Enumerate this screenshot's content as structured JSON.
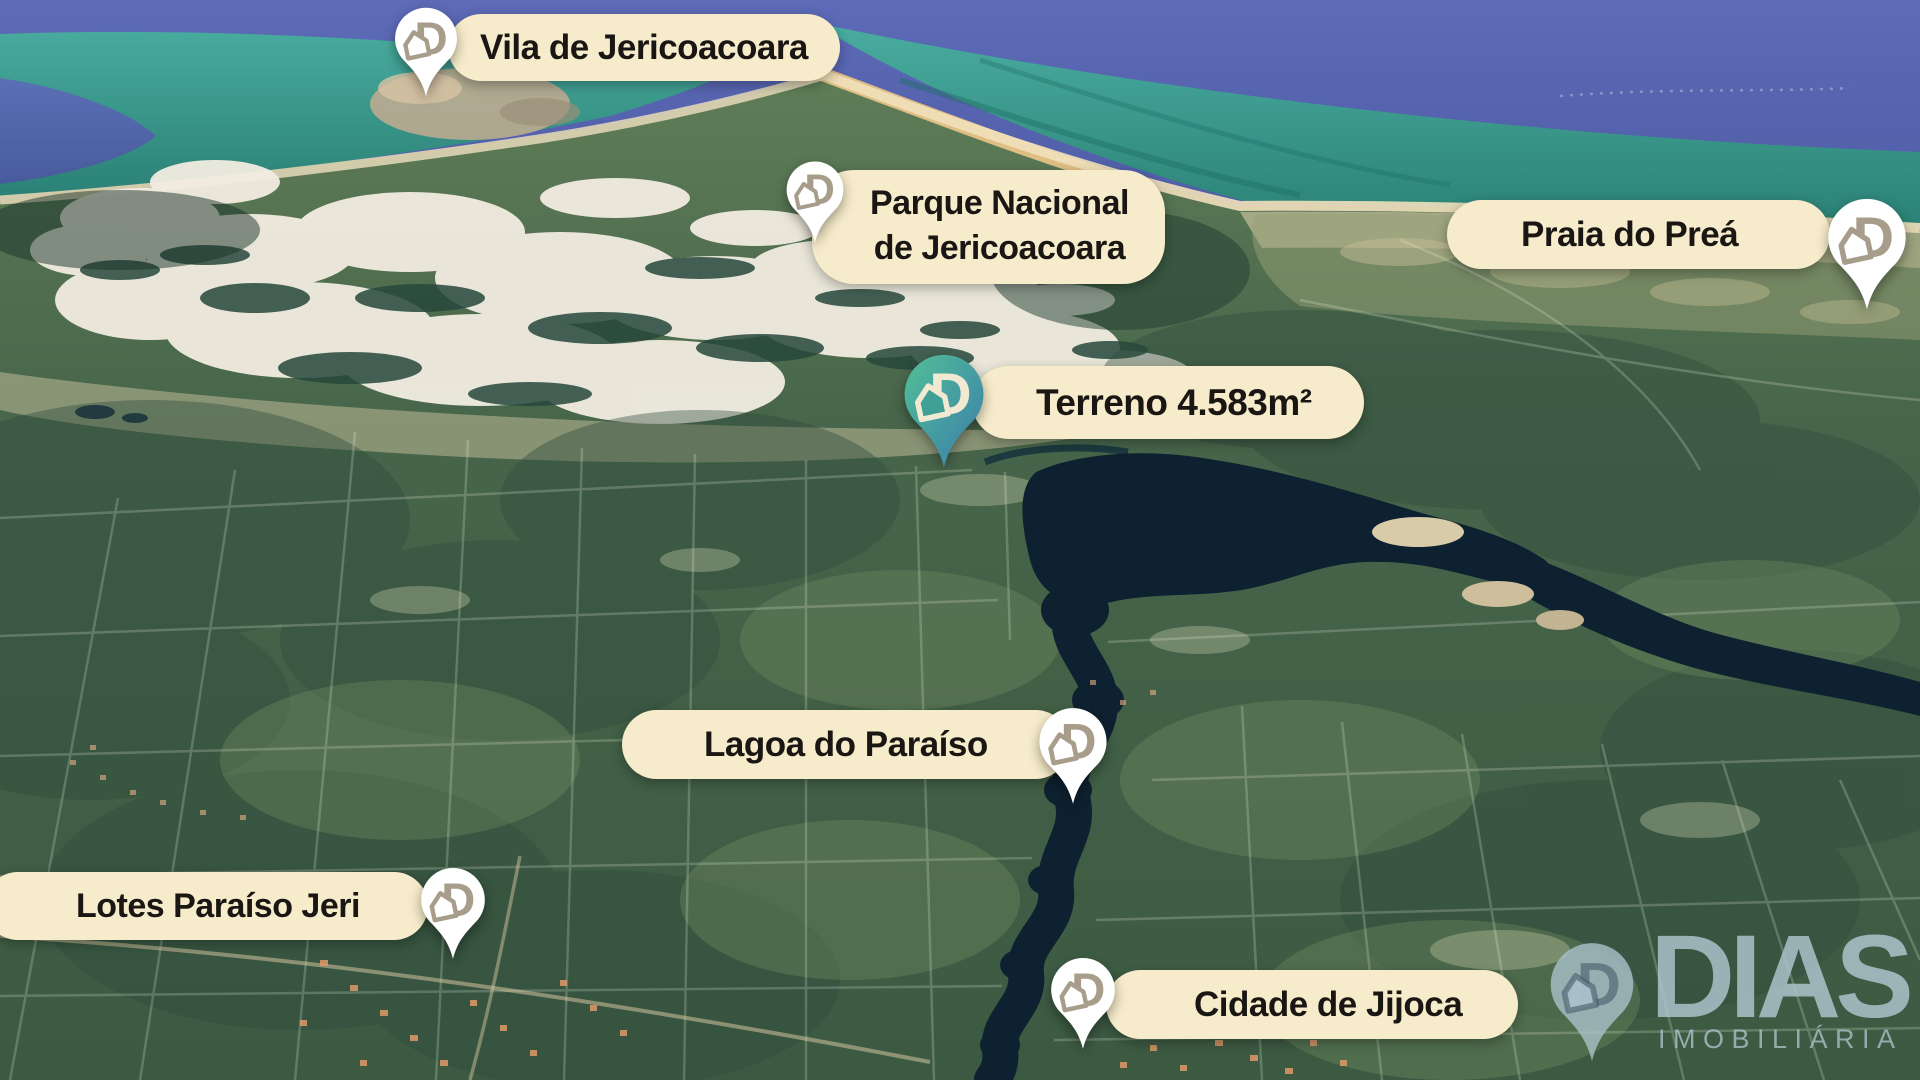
{
  "brand": {
    "letter": "D",
    "name": "DIAS",
    "tagline": "IMOBILIÁRIA"
  },
  "markers": [
    {
      "id": "vila",
      "label": "Vila de Jericoacoara",
      "pin": "white"
    },
    {
      "id": "parque",
      "label_line1": "Parque Nacional",
      "label_line2": "de Jericoacoara",
      "pin": "white"
    },
    {
      "id": "praia",
      "label": "Praia do Preá",
      "pin": "white"
    },
    {
      "id": "terreno",
      "label": "Terreno 4.583m²",
      "pin": "teal"
    },
    {
      "id": "lagoa",
      "label": "Lagoa do Paraíso",
      "pin": "white"
    },
    {
      "id": "lotes",
      "label": "Lotes Paraíso Jeri",
      "pin": "white"
    },
    {
      "id": "jijoca",
      "label": "Cidade de Jijoca",
      "pin": "white"
    }
  ],
  "colors": {
    "label_bg": "#f6ebca",
    "label_text": "#191613",
    "pin_white": "#ffffff",
    "pin_logo_taupe": "#a89d8b",
    "pin_logo_cream": "#f2e9d2",
    "pin_teal_start": "#52bf97",
    "pin_teal_end": "#3b7dab",
    "watermark": "#abc3cb",
    "sea_deep": "#505da9",
    "sea_shallow": "#2f8a7d",
    "land_green": "#45634a",
    "river_dark": "#0e2130"
  }
}
